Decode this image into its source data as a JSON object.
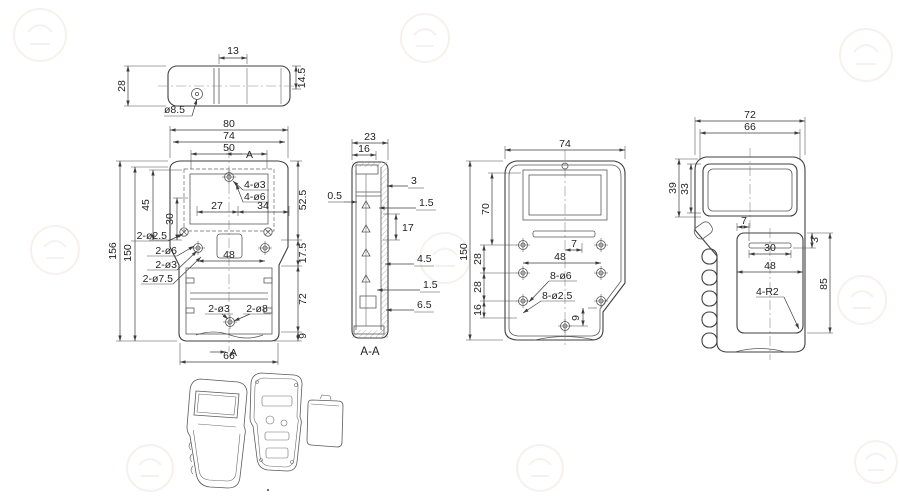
{
  "colors": {
    "background": "#ffffff",
    "line": "#3f3f3f",
    "dim_text": "#1f1f1f",
    "watermark": "#f0e6df"
  },
  "drawing": {
    "top_view": {
      "dim_width_13": "13",
      "dim_height_14_5": "14.5",
      "dim_depth_28": "28",
      "callout_hole": "ø8.5"
    },
    "front_view": {
      "dim_80": "80",
      "dim_74": "74",
      "dim_50": "50",
      "dim_45": "45",
      "dim_30": "30",
      "dim_27": "27",
      "dim_34": "34",
      "dim_52_5": "52.5",
      "dim_17_5": "17.5",
      "dim_72": "72",
      "dim_9": "9",
      "dim_48": "48",
      "dim_66": "66",
      "dim_156": "156",
      "dim_150": "150",
      "callout_2_d2_5": "2-ø2.5",
      "callout_2_d6": "2-ø6",
      "callout_2_d3": "2-ø3",
      "callout_2_d7_5": "2-ø7.5",
      "callout_4_d3": "4-ø3",
      "callout_4_d6": "4-ø6",
      "callout_2_d3_b": "2-ø3",
      "callout_2_d8": "2-ø8",
      "section_mark_top": "A",
      "section_mark_bottom": "A"
    },
    "section_view": {
      "label": "A-A",
      "dim_23": "23",
      "dim_16": "16",
      "dim_0_5": "0.5",
      "dim_3": "3",
      "dim_1_5_a": "1.5",
      "dim_17": "17",
      "dim_4_5": "4.5",
      "dim_1_5_b": "1.5",
      "dim_6_5": "6.5"
    },
    "rear_inner_view": {
      "dim_74": "74",
      "dim_150": "150",
      "dim_70": "70",
      "dim_28_a": "28",
      "dim_28_b": "28",
      "dim_16": "16",
      "dim_7": "7",
      "dim_48": "48",
      "callout_8_d6": "8-ø6",
      "callout_8_d2_5": "8-ø2.5",
      "dim_9": "9"
    },
    "rear_outer_view": {
      "dim_72": "72",
      "dim_66": "66",
      "dim_39": "39",
      "dim_33": "33",
      "dim_7": "7",
      "dim_30": "30",
      "dim_3": "3",
      "dim_48": "48",
      "dim_85": "85",
      "callout_4_r2": "4-R2"
    }
  }
}
